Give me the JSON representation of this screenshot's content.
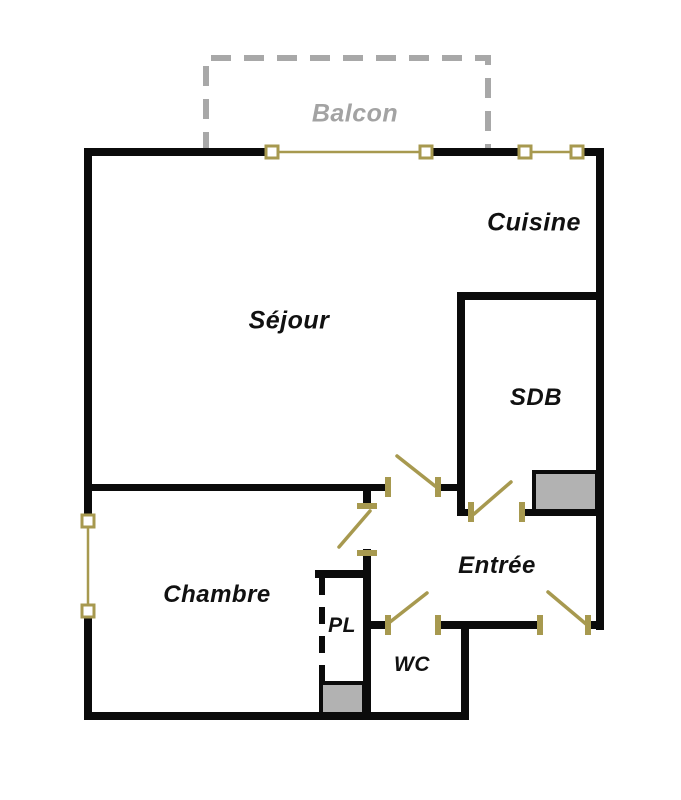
{
  "page": {
    "type": "apartment-floor-plan"
  },
  "colors": {
    "background": "#ffffff",
    "wall": "#0b0b0b",
    "joinery": "#a7994f",
    "fixture": "#b2b2b2",
    "balcony": "#a8a8a8",
    "balcony_label": "#a3a3a3",
    "label": "#111111"
  },
  "rooms": {
    "balcon": {
      "label": "Balcon"
    },
    "cuisine": {
      "label": "Cuisine"
    },
    "sejour": {
      "label": "Séjour"
    },
    "sdb": {
      "label": "SDB"
    },
    "chambre": {
      "label": "Chambre"
    },
    "entree": {
      "label": "Entrée"
    },
    "pl": {
      "label": "PL"
    },
    "wc": {
      "label": "WC"
    }
  }
}
